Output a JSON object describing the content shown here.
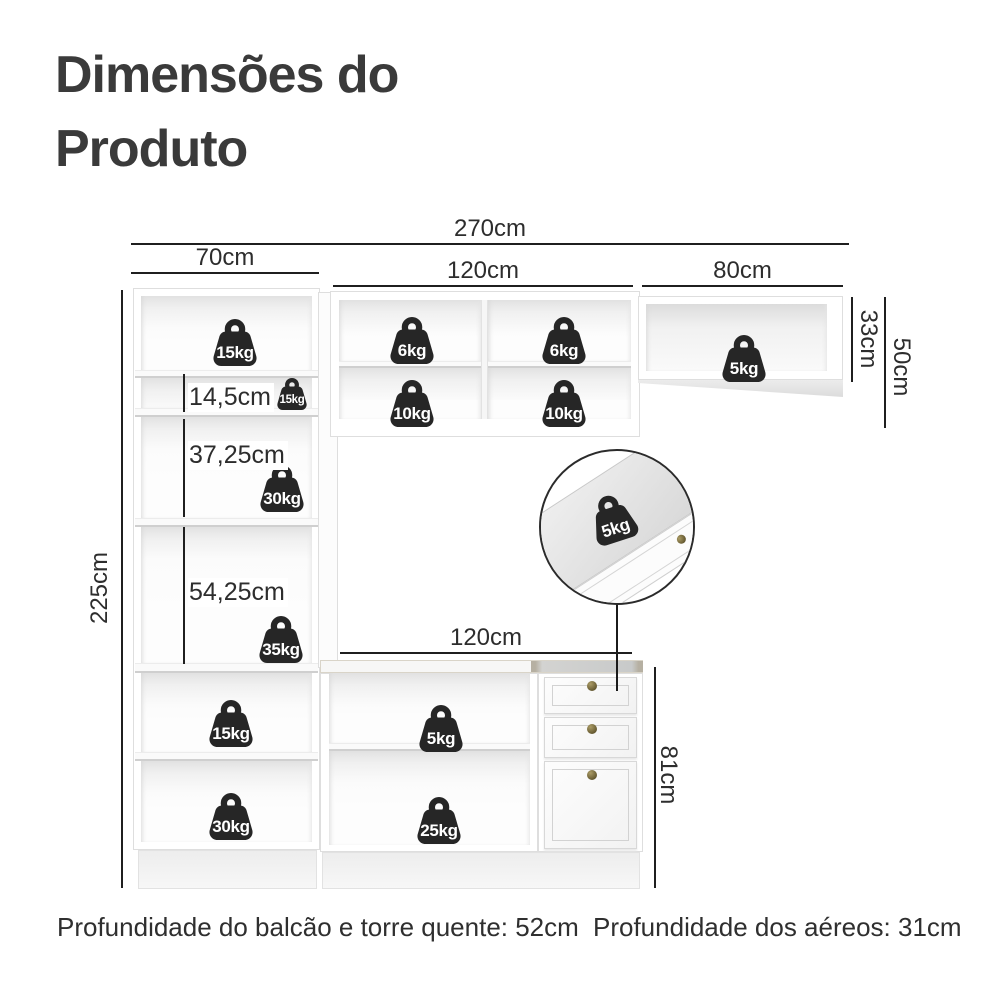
{
  "title": {
    "line1": "Dimensões do",
    "line2": "Produto"
  },
  "dims": {
    "total_width": "270cm",
    "tower_width": "70cm",
    "aerial_width": "120cm",
    "right_aerial_width": "80cm",
    "right_aerial_height": "33cm",
    "right_aerial_total_height": "50cm",
    "tower_height": "225cm",
    "shelf_gap_small": "14,5cm",
    "shelf_gap_mid": "37,25cm",
    "shelf_gap_large": "54,25cm",
    "counter_width": "120cm",
    "counter_height": "81cm"
  },
  "weights": {
    "tower_top": "15kg",
    "tower_small_shelf": "15kg",
    "tower_mid": "30kg",
    "tower_lower_mid": "35kg",
    "tower_bottom_upper": "15kg",
    "tower_bottom_lower": "30kg",
    "aerial_top_left": "6kg",
    "aerial_top_right": "6kg",
    "aerial_bottom_left": "10kg",
    "aerial_bottom_right": "10kg",
    "right_aerial": "5kg",
    "drawer_detail": "5kg",
    "counter_shelf_top": "5kg",
    "counter_shelf_bottom": "25kg"
  },
  "footer": {
    "left_note": "Profundidade do balcão e torre quente: 52cm",
    "right_note": "Profundidade dos aéreos: 31cm"
  }
}
